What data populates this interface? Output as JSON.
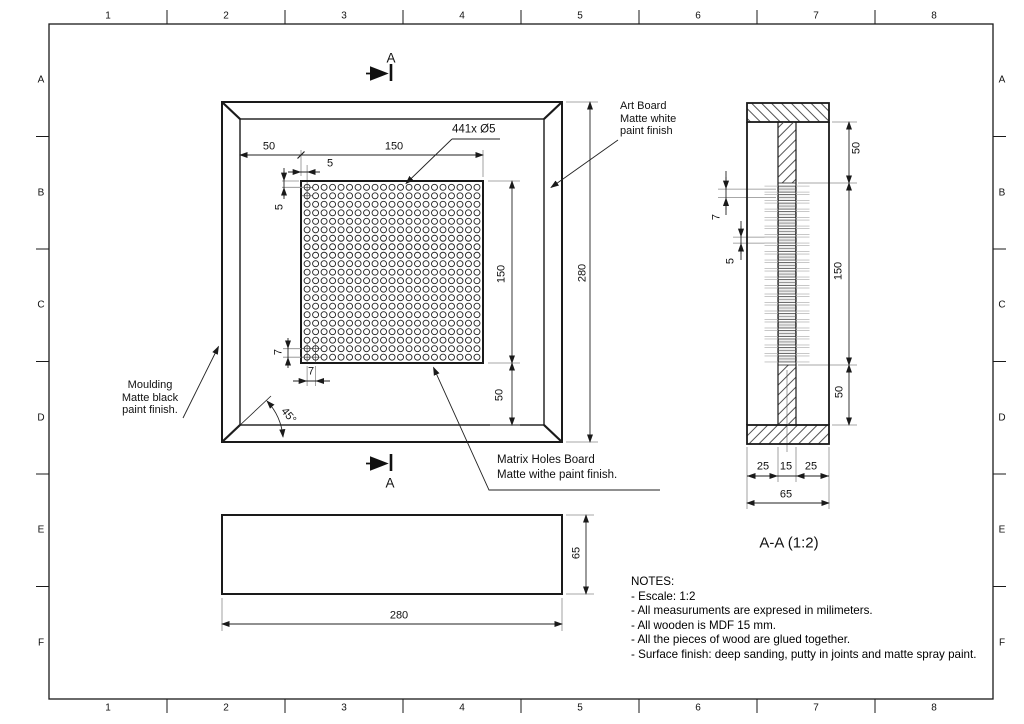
{
  "grid": {
    "columns": [
      "1",
      "2",
      "3",
      "4",
      "5",
      "6",
      "7",
      "8"
    ],
    "rows": [
      "A",
      "B",
      "C",
      "D",
      "E",
      "F"
    ]
  },
  "cut_label": "A",
  "front": {
    "callout": "441x Ø5",
    "holes": {
      "rows": 21,
      "cols": 21
    },
    "dims": {
      "margin_left": "50",
      "board_w": "150",
      "off_x": "5",
      "off_y": "5",
      "pitch_y": "7",
      "pitch_x": "7",
      "angle": "45°",
      "board_h": "150",
      "margin_bot": "50",
      "overall": "280"
    },
    "ann_moulding": [
      "Moulding",
      "Matte black",
      "paint finish."
    ],
    "ann_artboard": [
      "Art Board",
      "Matte white",
      "paint finish"
    ],
    "ann_matrix": [
      "Matrix Holes Board",
      "Matte withe paint finish."
    ]
  },
  "side": {
    "height": "65",
    "width": "280"
  },
  "section": {
    "title": "A-A (1:2)",
    "seg_top": "50",
    "seg_mid": "150",
    "seg_bot": "50",
    "pitch": "7",
    "hole": "5",
    "w1": "25",
    "w2": "15",
    "w3": "25",
    "w_total": "65"
  },
  "notes": {
    "title": "NOTES:",
    "items": [
      "- Escale: 1:2",
      "- All measuruments are expresed in milimeters.",
      "- All wooden is MDF 15 mm.",
      "- All the pieces of wood are glued together.",
      "- Surface finish: deep sanding, putty in joints and matte spray paint."
    ]
  },
  "colors": {
    "line": "#1a1a1a",
    "extension": "#8a8a8a",
    "hatch": "#3f3f3f"
  }
}
